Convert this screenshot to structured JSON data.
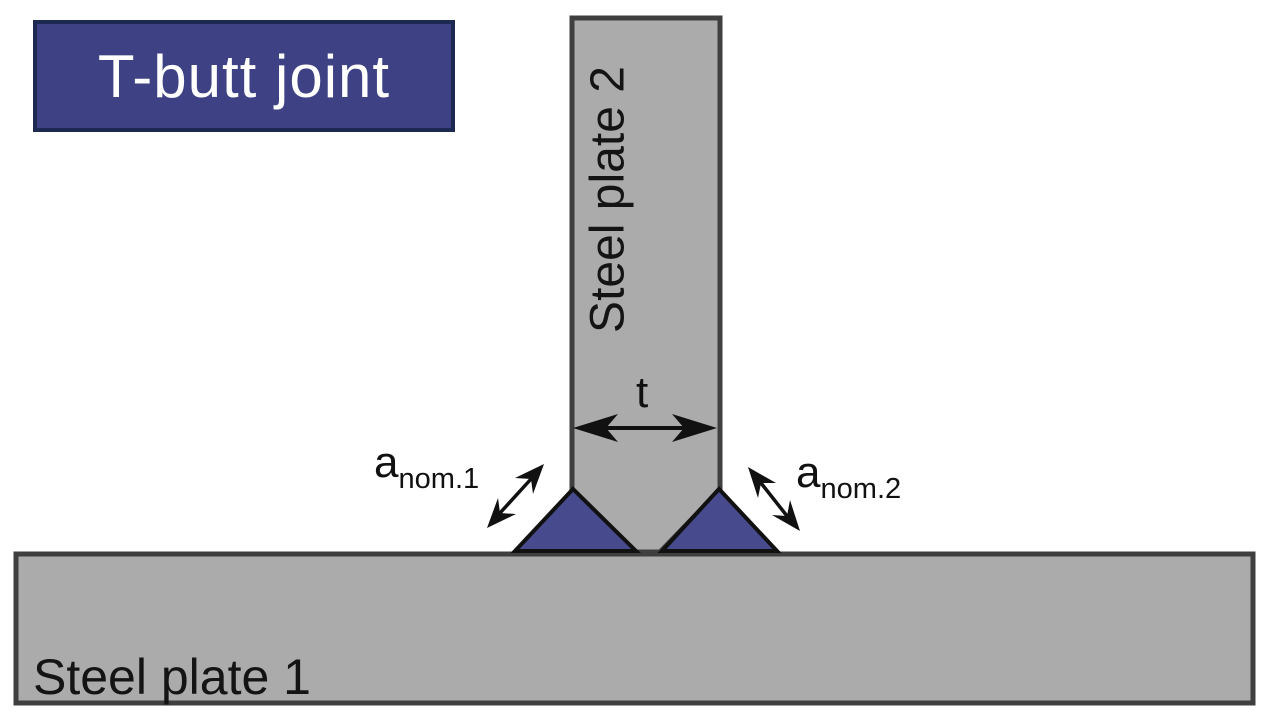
{
  "title": {
    "label": "T-butt joint"
  },
  "plates": {
    "plate1_label": "Steel plate 1",
    "plate2_label": "Steel plate 2"
  },
  "dimensions": {
    "thickness_label": "t",
    "weld_left": {
      "main": "a",
      "sub": "nom.1"
    },
    "weld_right": {
      "main": "a",
      "sub": "nom.2"
    }
  },
  "colors": {
    "background": "#ffffff",
    "plate_fill": "#ababab",
    "plate_outline": "#3f3f3f",
    "weld_fill": "#474b8d",
    "weld_outline": "#111111",
    "title_fill": "#3e4284",
    "title_outline": "#1d2950",
    "title_text": "#ffffff",
    "annotation": "#111111"
  }
}
